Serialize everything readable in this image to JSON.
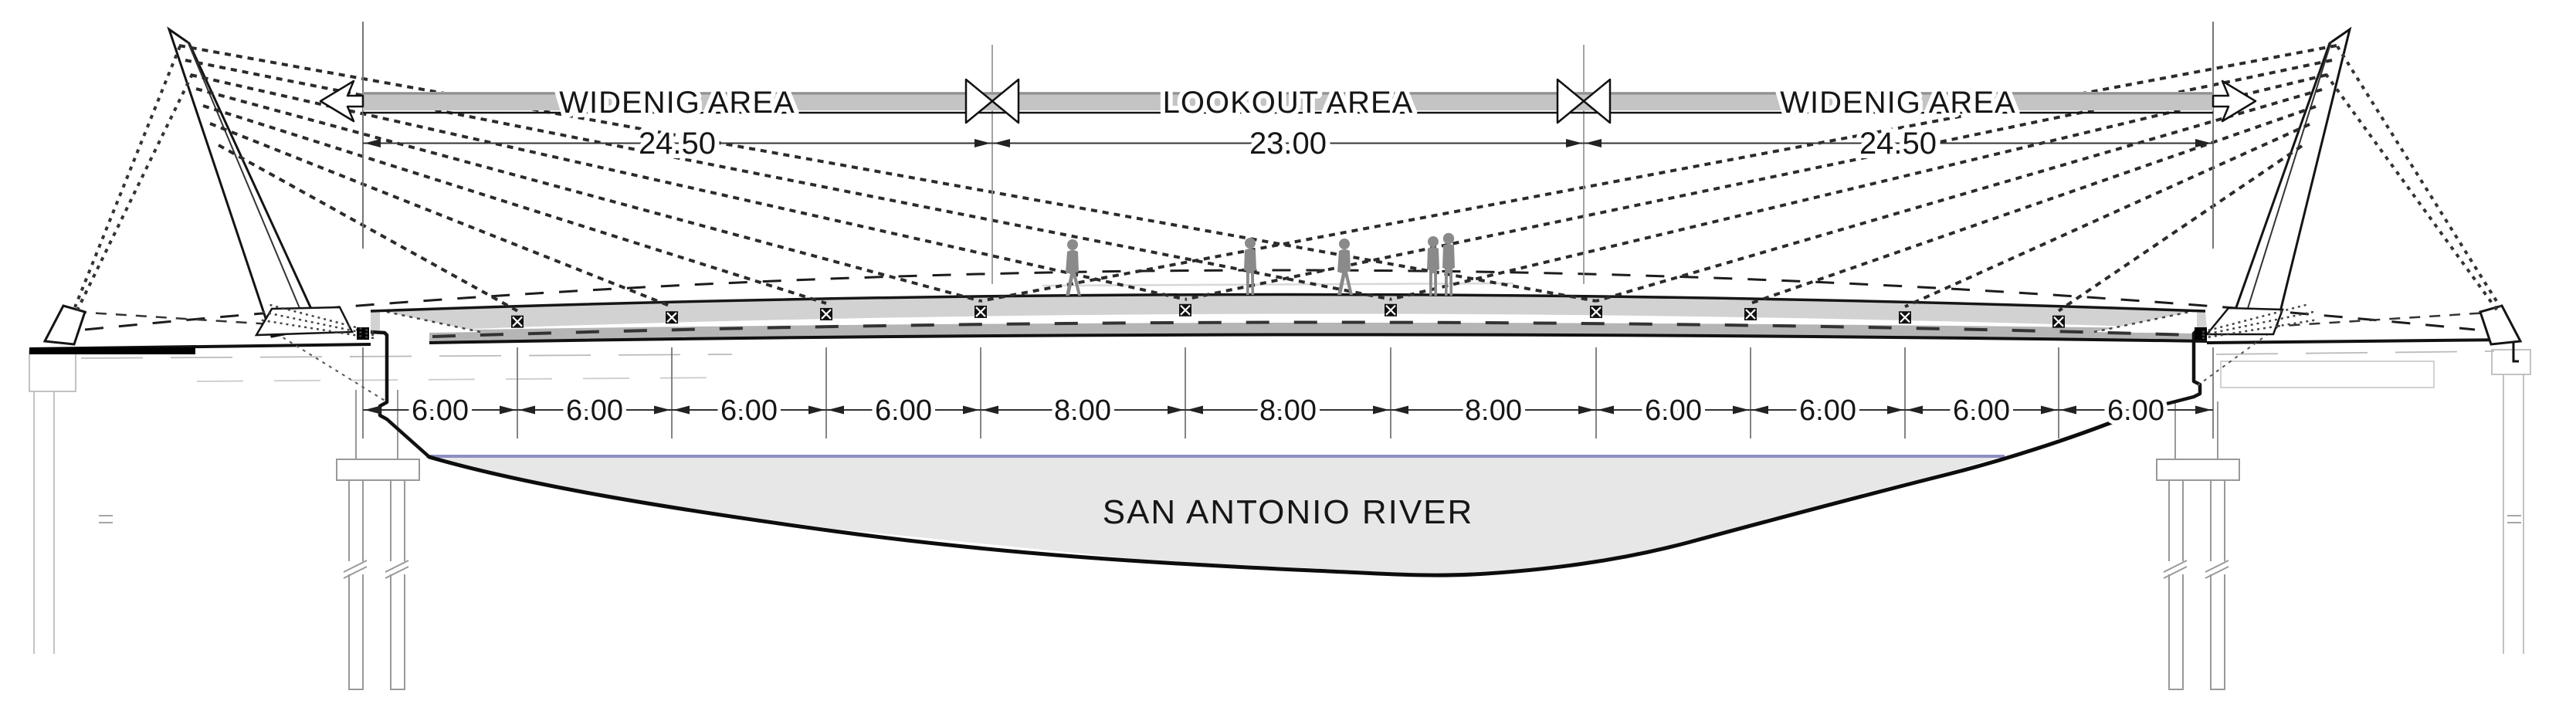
{
  "drawing": {
    "banner": {
      "segments": [
        {
          "label": "WIDENIG AREA",
          "dim": "24.50"
        },
        {
          "label": "LOOKOUT AREA",
          "dim": "23.00"
        },
        {
          "label": "WIDENIG AREA",
          "dim": "24.50"
        }
      ]
    },
    "bottom_dims": [
      {
        "value": "6.00"
      },
      {
        "value": "6.00"
      },
      {
        "value": "6.00"
      },
      {
        "value": "6.00"
      },
      {
        "value": "8.00"
      },
      {
        "value": "8.00"
      },
      {
        "value": "8.00"
      },
      {
        "value": "6.00"
      },
      {
        "value": "6.00"
      },
      {
        "value": "6.00"
      },
      {
        "value": "6.00"
      }
    ],
    "river_label": "SAN ANTONIO RIVER"
  },
  "colors": {
    "band": "#c4c4c4",
    "band_top": "#909090",
    "deck": "#d2d2d2",
    "deck_edge": "#b5b5b5",
    "water": "#e7e7e7",
    "water_line": "#8e8ec4",
    "figure": "#8a8a8a",
    "line_dark": "#161616",
    "line_light": "#aaaaaa"
  }
}
